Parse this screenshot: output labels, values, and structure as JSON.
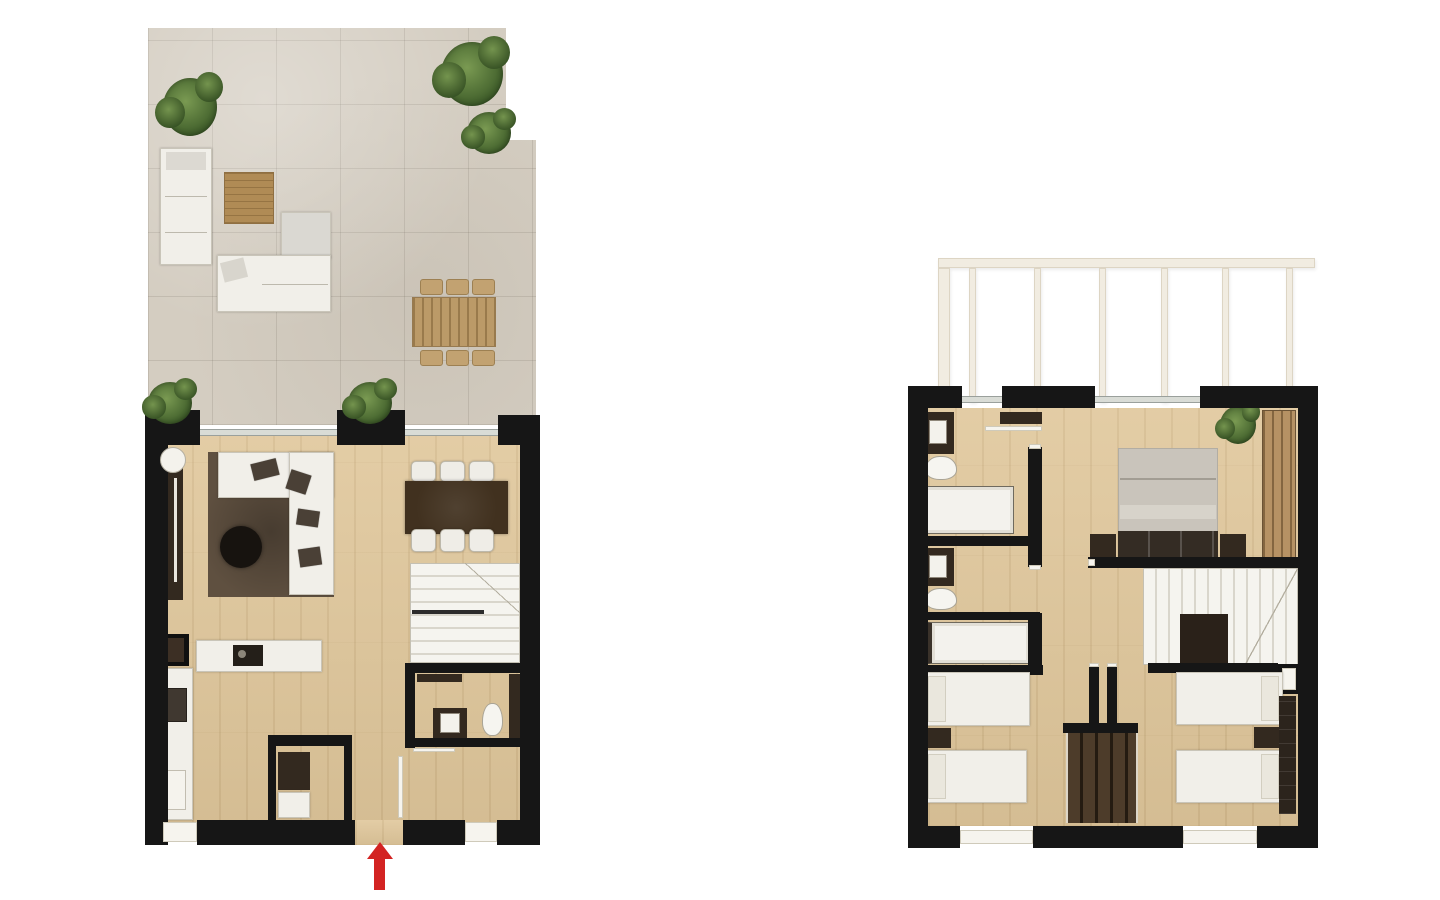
{
  "canvas": {
    "width": 1440,
    "height": 900,
    "background": "#ffffff"
  },
  "colors": {
    "wall": "#161616",
    "wood_floor": "#e0c79b",
    "terrace_stone": "#d4cdc1",
    "white_furniture": "#f1efe9",
    "dark_furniture": "#33291f",
    "rug": "#5f5040",
    "wood_furniture": "#bb9a68",
    "plant_green_dark": "#2f4b1f",
    "bed_gray": "#c9c4bb",
    "pergola": "#f1ece1",
    "arrow_red": "#d32322"
  },
  "annotations": {
    "entrance_arrow": {
      "direction": "up",
      "color": "#d32322"
    }
  }
}
